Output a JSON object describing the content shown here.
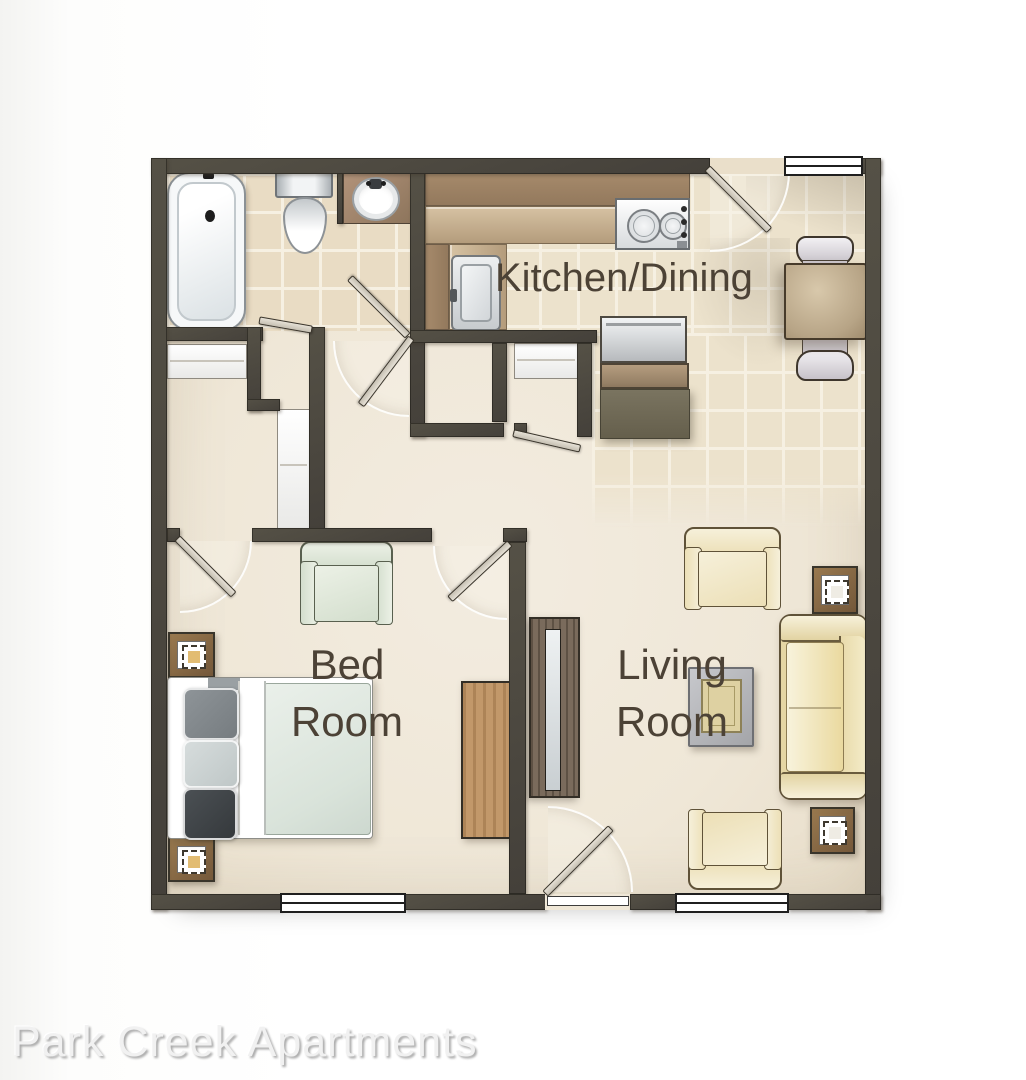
{
  "footer": {
    "text": "Park Creek Apartments"
  },
  "rooms": {
    "kitchen_dining": {
      "label": "Kitchen/Dining"
    },
    "bedroom": {
      "line1": "Bed",
      "line2": "Room"
    },
    "living_room": {
      "line1": "Living",
      "line2": "Room"
    }
  },
  "palette": {
    "wall": "#4b473d",
    "floor": "#efe7d7",
    "bath_tile": "#e9dcc4",
    "kitchen_tile": "#ece2cc",
    "counter_dark": "#9c8164",
    "counter_light": "#c9b392",
    "wood": "#8a6d48",
    "sofa_cream": "#e5d6a4",
    "bed_mattress": "#dde6da",
    "label_text": "#4c4236",
    "footer_text": "#f1f1f1"
  },
  "furniture_icons": [
    "bathtub",
    "toilet",
    "vanity-sink",
    "kitchen-counter",
    "stove-cooktop",
    "kitchen-sink",
    "refrigerator",
    "cabinet",
    "dining-table",
    "dining-chair",
    "closet-sliding-door",
    "door-leaf",
    "window",
    "bed",
    "pillow",
    "nightstand-lamp",
    "dresser",
    "armchair",
    "tv-console",
    "sofa",
    "end-table-lamp",
    "coffee-table"
  ]
}
